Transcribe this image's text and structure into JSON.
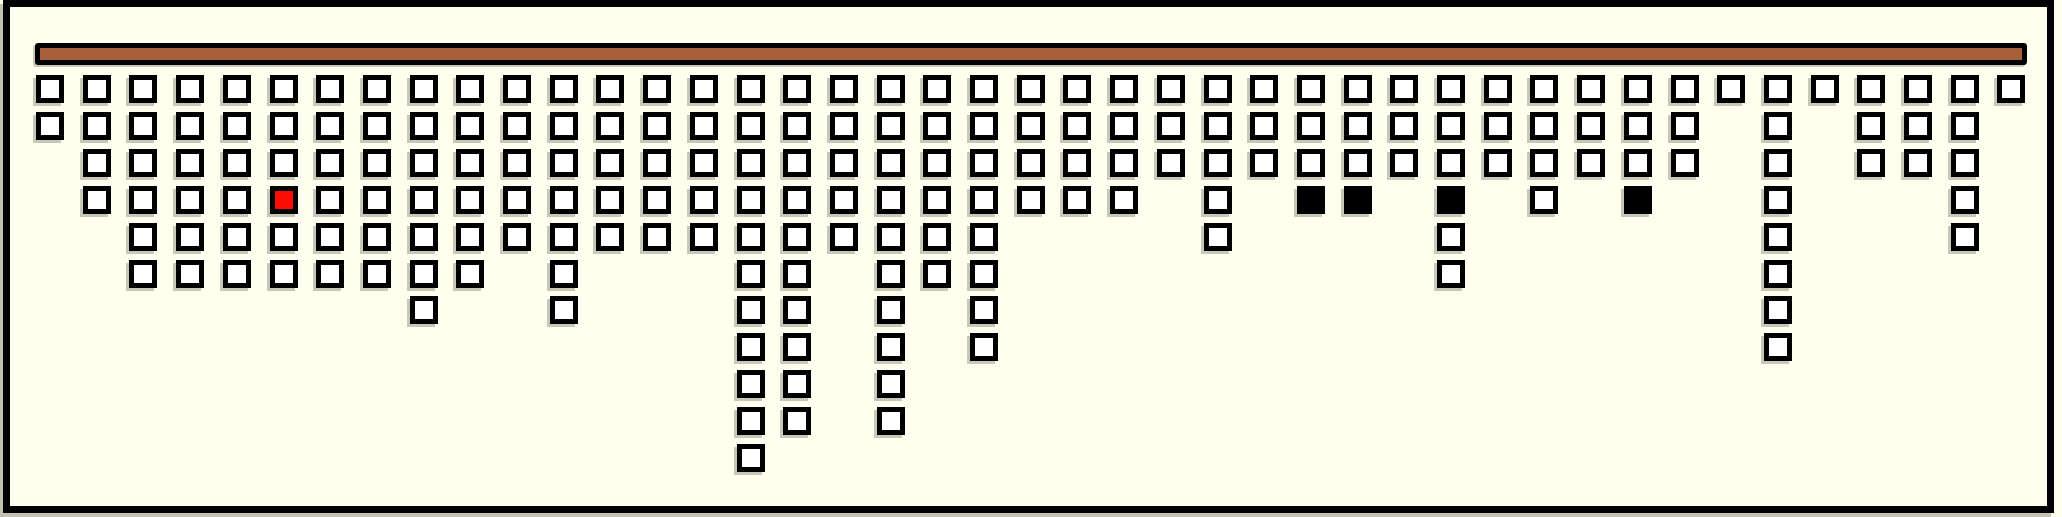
{
  "canvas": {
    "width": 2062,
    "height": 517,
    "background_color": "#FFFFF0"
  },
  "frame": {
    "x": 3,
    "y": 0,
    "width": 2051,
    "height": 513,
    "thickness": 7,
    "color": "#000000"
  },
  "bar": {
    "x": 35,
    "y": 43,
    "width": 1992,
    "height": 22,
    "fill_color": "#A6613B",
    "outline_color": "#000000",
    "outline_width": 5
  },
  "grid": {
    "columns": 43,
    "origin_x": 36,
    "origin_y": 75,
    "step_x": 46.7,
    "step_y": 36.9,
    "cell_size": 28,
    "cell_border_width": 5,
    "cell_fill_color": "#FFFFFF",
    "cell_outline_color": "#000000",
    "red_color": "#F90D00",
    "black_color": "#000000",
    "heights": [
      2,
      4,
      6,
      6,
      6,
      6,
      6,
      6,
      7,
      6,
      5,
      7,
      5,
      5,
      5,
      11,
      10,
      5,
      10,
      6,
      8,
      4,
      4,
      4,
      3,
      5,
      3,
      4,
      4,
      3,
      6,
      3,
      4,
      3,
      4,
      3,
      1,
      8,
      1,
      3,
      3,
      5,
      1
    ],
    "special_cells": [
      {
        "column": 6,
        "row": 4,
        "fill": "#F90D00",
        "label": "red-cell"
      },
      {
        "column": 28,
        "row": 4,
        "fill": "#000000",
        "label": "black-cell"
      },
      {
        "column": 29,
        "row": 4,
        "fill": "#000000",
        "label": "black-cell"
      },
      {
        "column": 31,
        "row": 4,
        "fill": "#000000",
        "label": "black-cell"
      },
      {
        "column": 35,
        "row": 4,
        "fill": "#000000",
        "label": "black-cell"
      }
    ],
    "total_cells": 211,
    "white_cells": 206
  }
}
